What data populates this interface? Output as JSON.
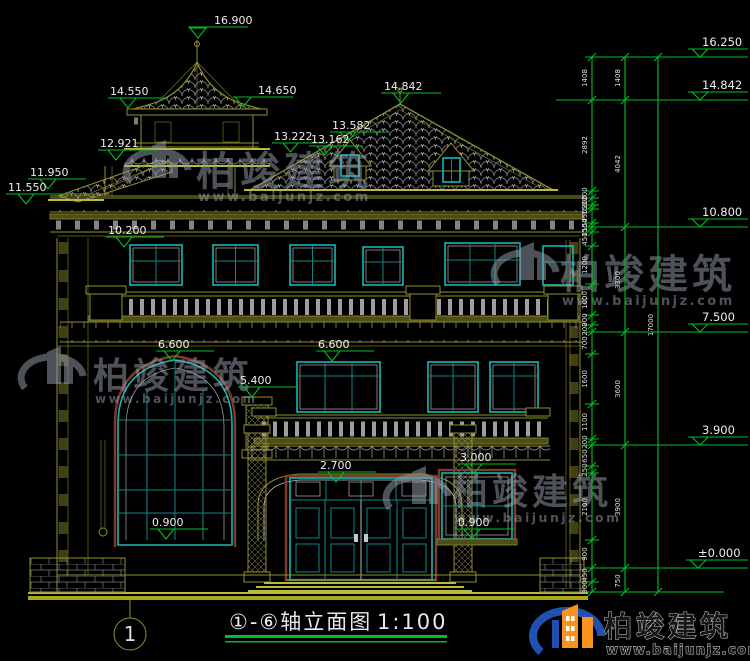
{
  "title": {
    "axis_label": "①-⑥轴立面图",
    "scale": "1:100",
    "axis_bubble": "1"
  },
  "watermark": {
    "name": "柏竣建筑",
    "url": "www.baijunjz.com"
  },
  "logo": {
    "name": "柏竣建筑",
    "url": "www.baijunjz.com"
  },
  "elev": {
    "v16900": "16.900",
    "v14550": "14.550",
    "v14650": "14.650",
    "v14842": "14.842",
    "v13582": "13.582",
    "v13222": "13.222",
    "v13162": "13.162",
    "v12921": "12.921",
    "v11950": "11.950",
    "v11550": "11.550",
    "v10200": "10.200",
    "v6600a": "6.600",
    "v5400": "5.400",
    "v6600b": "6.600",
    "v2700": "2.700",
    "v3000": "3.000",
    "v0900a": "0.900",
    "v0900b": "0.900",
    "right": {
      "v16250": "16.250",
      "v14842": "14.842",
      "v10800": "10.800",
      "v7500": "7.500",
      "v3900": "3.900",
      "v0000": "±0.000"
    }
  },
  "dim": {
    "fine": [
      "1408",
      "2892",
      "200",
      "200",
      "150",
      "450",
      "150",
      "150",
      "450",
      "1200",
      "1000",
      "300",
      "200",
      "700",
      "1600",
      "1100",
      "200",
      "650",
      "250",
      "2100",
      "900",
      "450",
      "300"
    ],
    "mid": [
      "1408",
      "4042",
      "3300",
      "3600",
      "3900",
      "750"
    ],
    "total": "17000"
  }
}
